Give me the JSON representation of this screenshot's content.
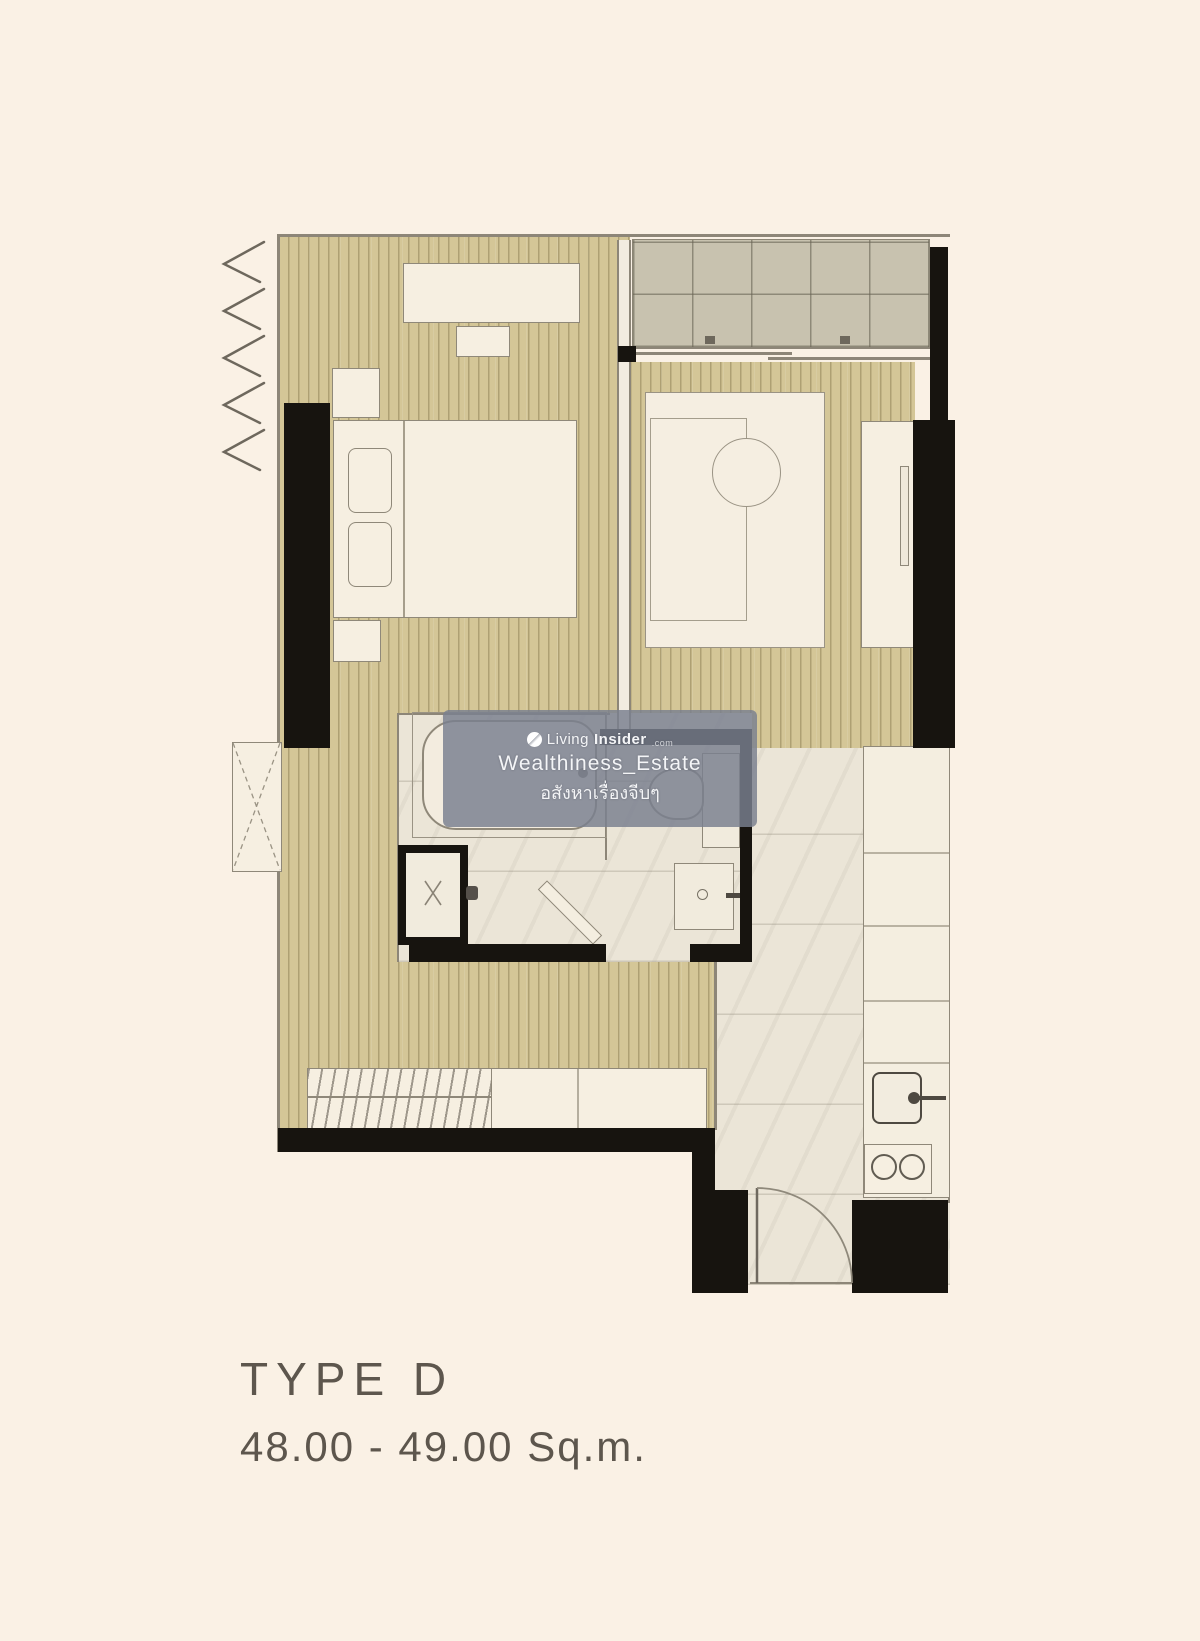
{
  "page": {
    "background": "#faf1e5"
  },
  "watermark": {
    "brand_light": "Living",
    "brand_bold": "Insider",
    "brand_tld": ".com",
    "line2": "Wealthiness_Estate",
    "line3": "อสังหาเรื่องจีบๆ",
    "bg_color": "rgba(122,127,143,0.83)"
  },
  "caption": {
    "title": "TYPE D",
    "area": "48.00 - 49.00 Sq.m."
  },
  "palette": {
    "background": "#faf1e5",
    "wall_black": "#17140f",
    "wood_floor": "#d4c697",
    "wood_stripe": "#b6a878",
    "balcony_tile": "#c8c2af",
    "grid_line": "#8b8575",
    "marble_floor": "#ebe5d7",
    "furniture_fill": "#f6efe1",
    "outline_gray": "#8d8678",
    "caption_text": "#5d564d"
  }
}
